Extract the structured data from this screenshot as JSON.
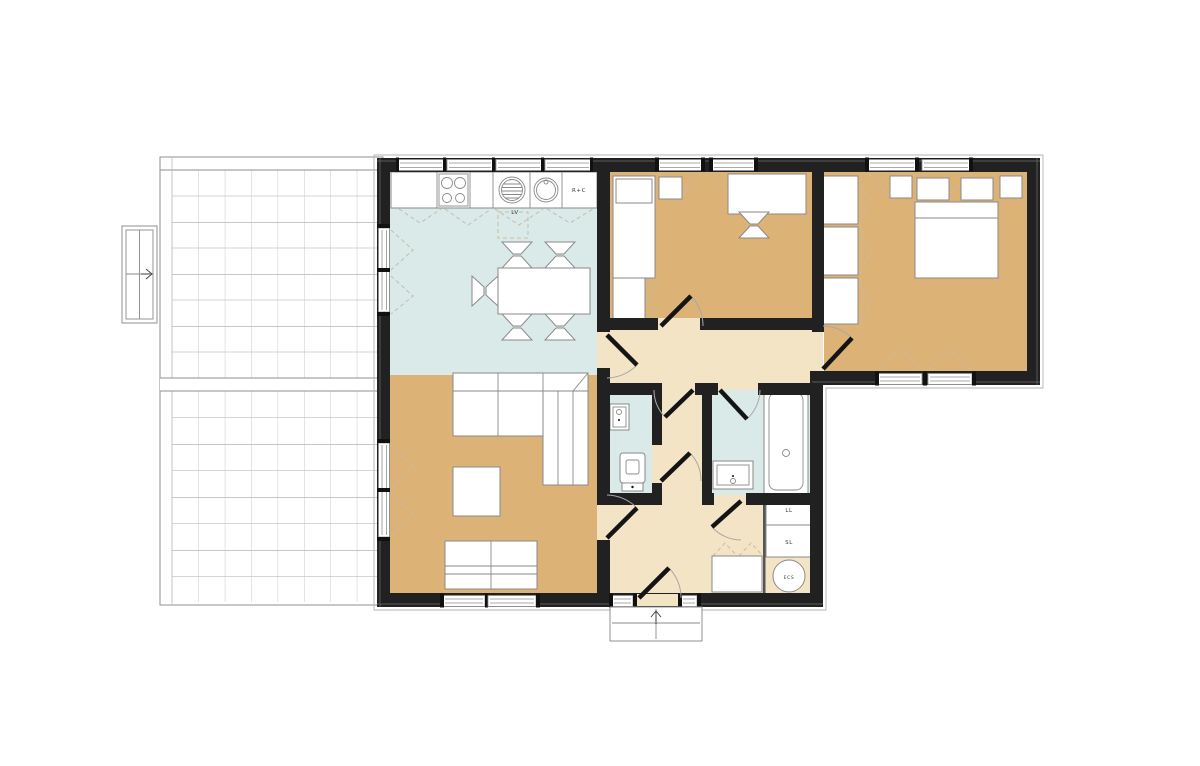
{
  "plan": {
    "appliance_labels": {
      "dishwasher": "LV",
      "fridge_freezer": "R+C",
      "washing_machine": "LL",
      "dryer": "SL",
      "water_heater": "ECS"
    },
    "colors": {
      "wall": "#212121",
      "wet_room_floor": "#d9eae8",
      "warm_room_floor": "#dcb277",
      "hallway_floor": "#f4e4c6",
      "furniture_fill": "#ffffff",
      "furniture_stroke": "#8a8a8a",
      "terrace_grid_line": "#8f8f8f",
      "dashed_indicator": "#c6bca8"
    }
  }
}
